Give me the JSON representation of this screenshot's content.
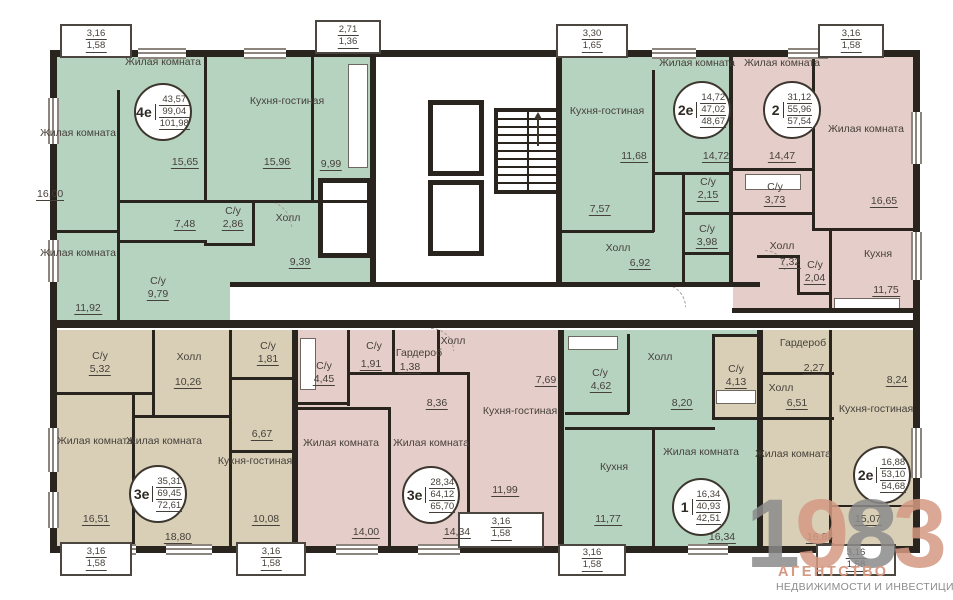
{
  "colors": {
    "wall": "#29241e",
    "green": "#b6d3c0",
    "pink": "#e5cdc9",
    "beige": "#d8cfb6",
    "ink": "#46403a",
    "logo_salmon": "#d59a84",
    "logo_gray": "#8b8b8b"
  },
  "labels": {
    "living": "Жилая комната",
    "kitchen_living": "Кухня-гостиная",
    "kitchen": "Кухня",
    "hall": "Холл",
    "wc": "С/у",
    "wardrobe": "Гардероб"
  },
  "apartments": {
    "a4e": {
      "type": "4е",
      "stats": [
        "43,57",
        "99,04",
        "101,98"
      ],
      "areas": {
        "living_center": "15,65",
        "kitchen_living": "15,96",
        "kitchen_niche": "9,99",
        "living_left_top": "16,00",
        "living_left_bottom": "11,92",
        "corridor": "7,48",
        "wc_small": "2,86",
        "wc_big": "9,79",
        "hall": "9,39"
      }
    },
    "a2e_top": {
      "type": "2е",
      "stats": [
        "14,72",
        "47,02",
        "48,67"
      ],
      "areas": {
        "kitchen_living": "11,68",
        "living": "14,72",
        "wc_1": "2,15",
        "wc_2": "3,98",
        "hall": "6,92",
        "corridor": "7,57"
      }
    },
    "a2": {
      "type": "2",
      "stats": [
        "31,12",
        "55,96",
        "57,54"
      ],
      "areas": {
        "living_left": "14,47",
        "living_right": "16,65",
        "wc_1": "3,73",
        "wc_2": "2,04",
        "hall": "7,32",
        "kitchen": "11,75"
      }
    },
    "a3e_left": {
      "type": "3е",
      "stats": [
        "35,31",
        "69,45",
        "72,61"
      ],
      "areas": {
        "wc_1": "5,32",
        "hall": "10,26",
        "wc_2": "1,81",
        "niche": "6,67",
        "living_left": "16,51",
        "living_middle": "18,80",
        "kitchen_living": "10,08"
      }
    },
    "a3e_mid": {
      "type": "3е",
      "stats": [
        "28,34",
        "64,12",
        "65,70"
      ],
      "areas": {
        "wc_1": "4,45",
        "wc_2": "1,91",
        "wardrobe": "1,38",
        "hall": "7,69",
        "corridor": "8,36",
        "kitchen_living": "11,99",
        "living_left": "14,00",
        "living_middle": "14,34"
      }
    },
    "a1": {
      "type": "1",
      "stats": [
        "16,34",
        "40,93",
        "42,51"
      ],
      "areas": {
        "wc": "4,62",
        "hall": "8,20",
        "kitchen": "11,77",
        "living": "16,34"
      }
    },
    "a2e_bottom": {
      "type": "2е",
      "stats": [
        "16,88",
        "53,10",
        "54,68"
      ],
      "areas": {
        "wc": "4,13",
        "wardrobe": "2,27",
        "hall": "6,51",
        "living": "16,88",
        "kitchen_living": "8,24",
        "terrace": "15,07"
      }
    }
  },
  "balconies": {
    "top_left": [
      "3,16",
      "1,58"
    ],
    "top_mid": [
      "2,71",
      "1,36"
    ],
    "top_center": [
      "3,30",
      "1,65"
    ],
    "top_right": [
      "3,16",
      "1,58"
    ],
    "bottom_left": [
      "3,16",
      "1,58"
    ],
    "bottom_mid_left": [
      "3,16",
      "1,58"
    ],
    "bottom_center": [
      "3,16",
      "1,58"
    ],
    "bottom_mid_right": [
      "3,16",
      "1,58"
    ],
    "bottom_right": [
      "3,16",
      "1,58"
    ]
  },
  "logo": {
    "digits": [
      "1",
      "9",
      "8",
      "3"
    ],
    "line1": "АГЕНТСТВО",
    "line2": "НЕДВИЖИМОСТИ И ИНВЕСТИЦИЙ"
  }
}
